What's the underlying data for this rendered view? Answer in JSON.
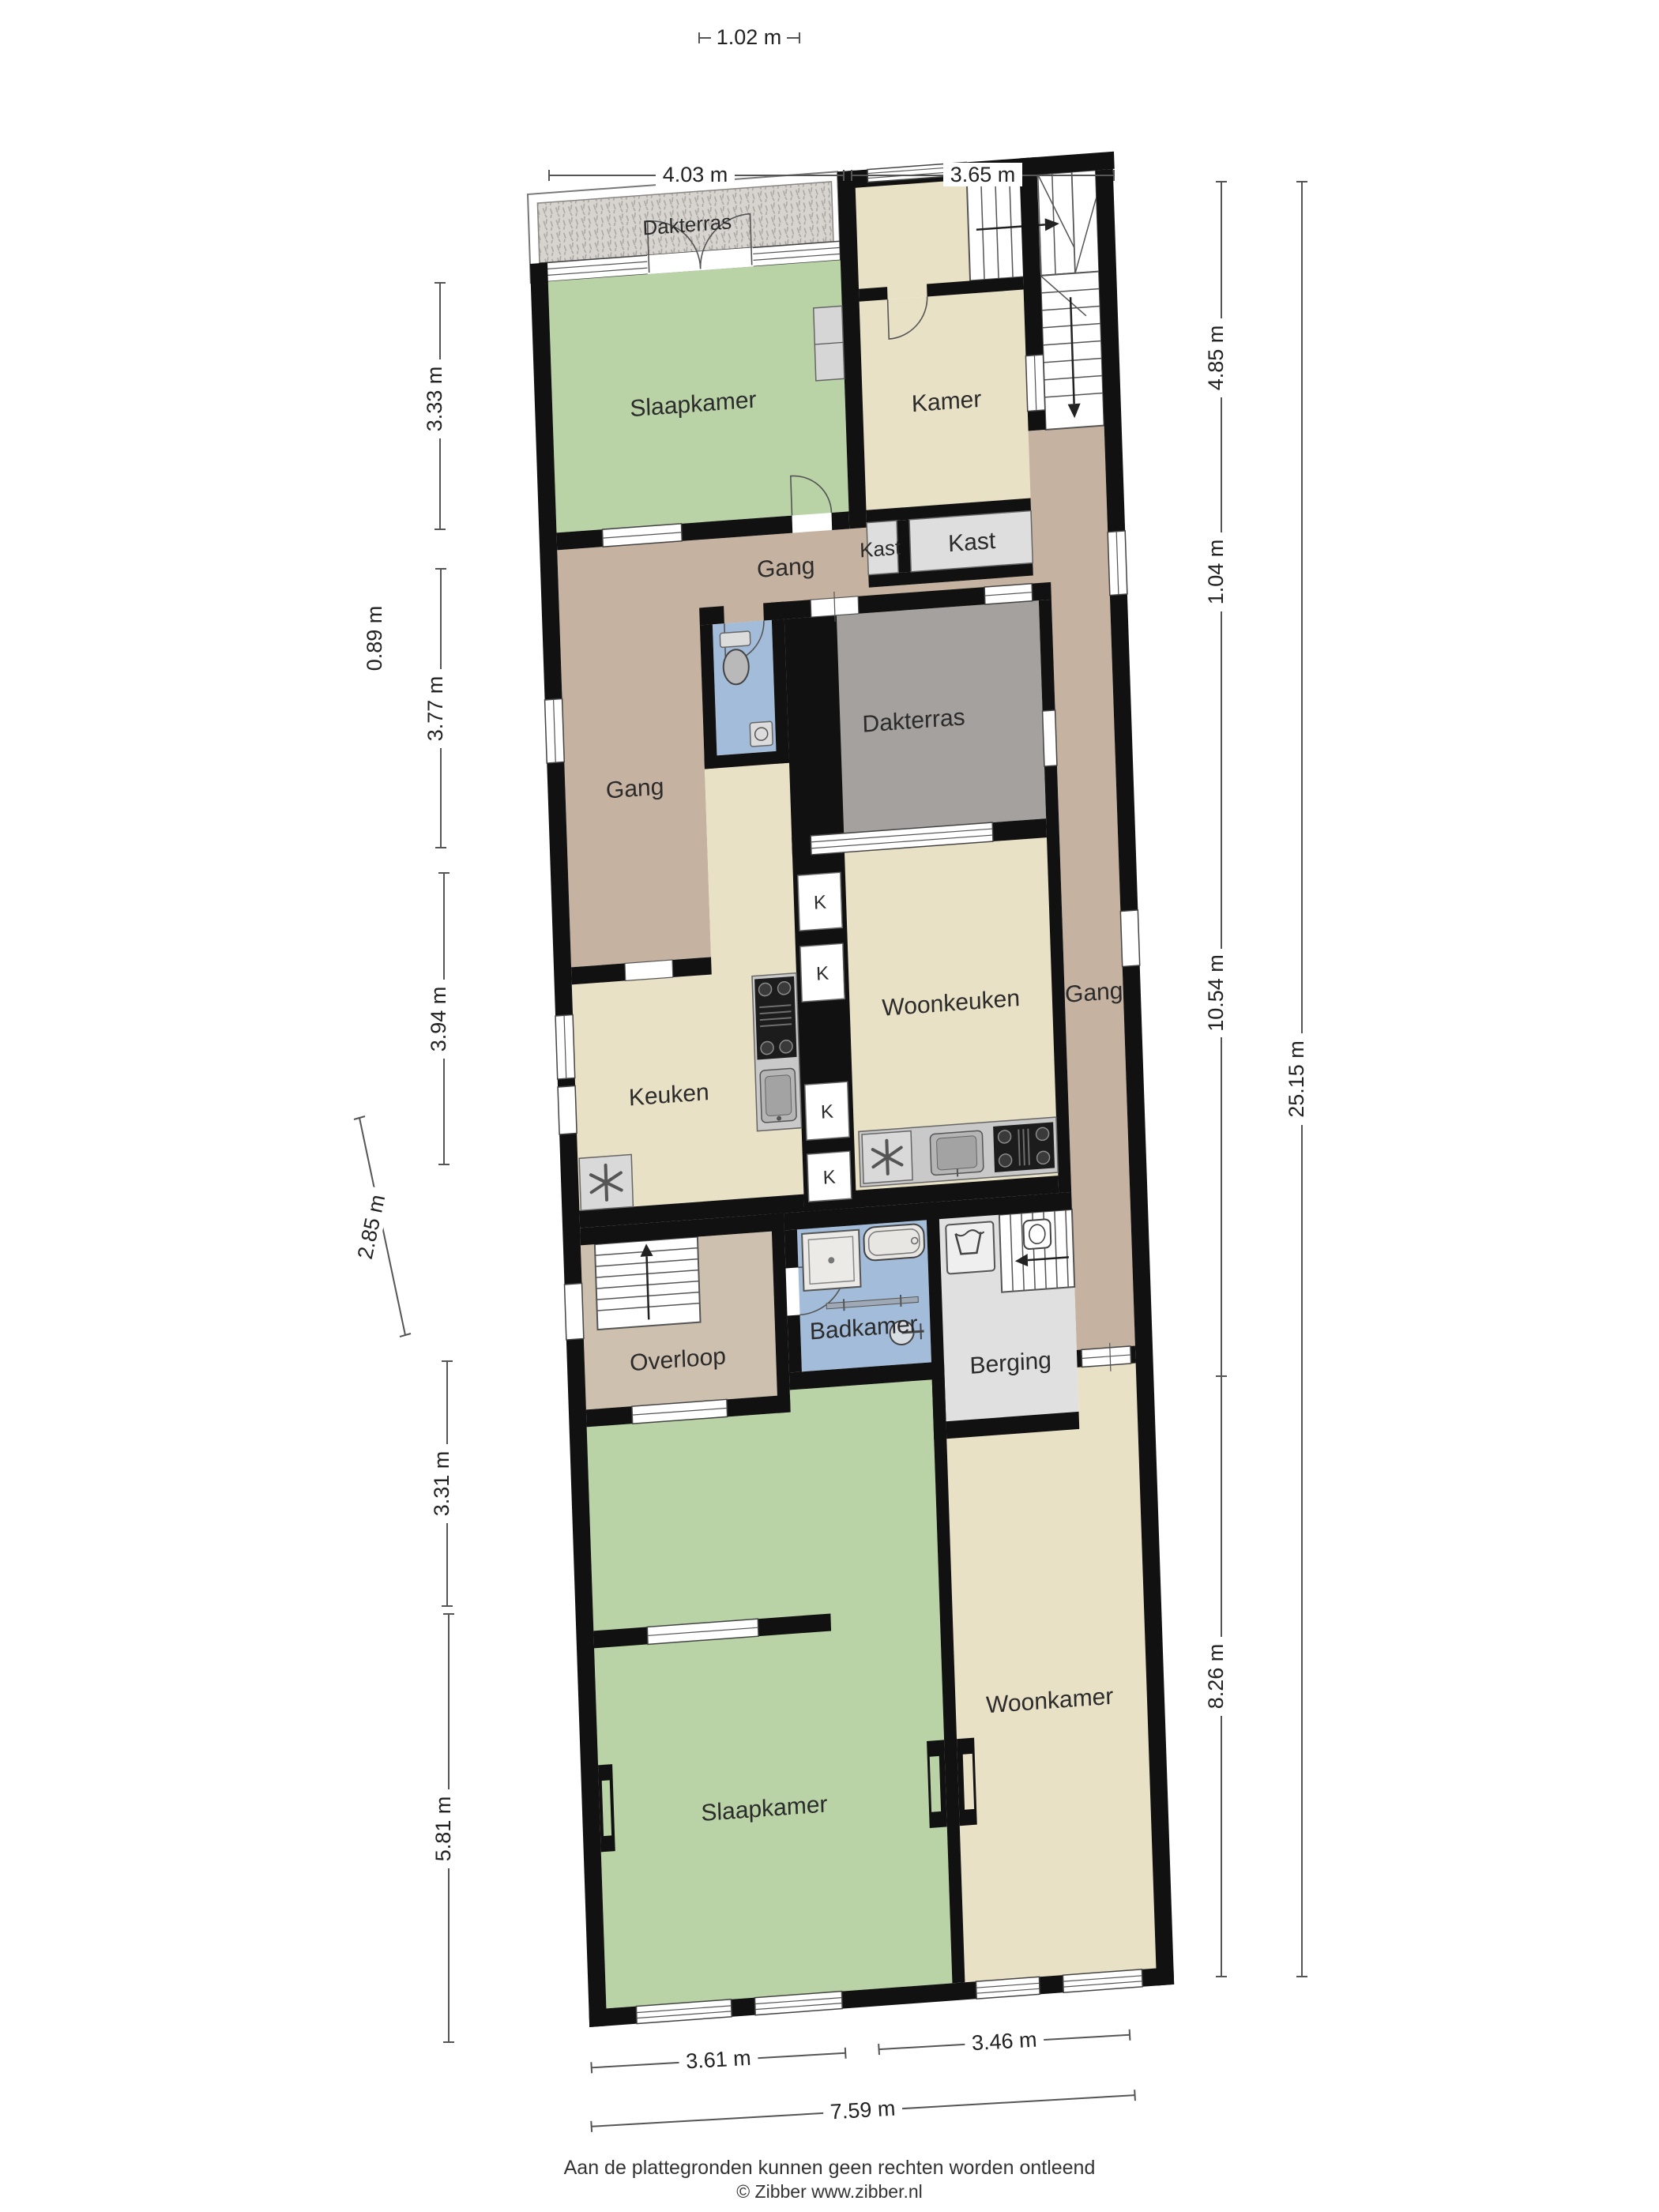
{
  "title": "Floor plan (plattegrond)",
  "rooms": {
    "dakterras_top": "Dakterras",
    "slaapkamer_top": "Slaapkamer",
    "kamer": "Kamer",
    "kast_small": "Kast",
    "kast_large": "Kast",
    "gang_top": "Gang",
    "gang_left": "Gang",
    "gang_right": "Gang",
    "dakterras_mid": "Dakterras",
    "keuken": "Keuken",
    "woonkeuken": "Woonkeuken",
    "overloop": "Overloop",
    "badkamer": "Badkamer",
    "berging": "Berging",
    "slaapkamer_bottom": "Slaapkamer",
    "woonkamer": "Woonkamer",
    "closet_label": "K"
  },
  "dimensions": {
    "top": [
      "1.02 m",
      "4.03 m",
      "3.65 m"
    ],
    "left": [
      "3.33 m",
      "0.89 m",
      "3.77 m",
      "3.94 m",
      "2.85 m",
      "3.31 m",
      "5.81 m"
    ],
    "right": [
      "4.85 m",
      "1.04 m",
      "10.54 m",
      "8.26 m",
      "25.15 m"
    ],
    "bottom": [
      "3.61 m",
      "3.46 m",
      "7.59 m"
    ]
  },
  "footer": {
    "disclaimer": "Aan de plattegronden kunnen geen rechten worden ontleend",
    "copyright": "© Zibber www.zibber.nl"
  },
  "colors": {
    "wall": "#111111",
    "bedroom_green": "#b9d3a6",
    "room_beige": "#e9e1c6",
    "gang_brown": "#c6b2a0",
    "overloop_taupe": "#cec0ae",
    "terrace_gray": "#a5a19e",
    "terrace_hatch_base": "#d7d4d0",
    "bath_blue": "#a3bcd9",
    "closet_gray": "#dedede",
    "counter_gray": "#c9c9c9",
    "stove_black": "#1c1c1c"
  }
}
